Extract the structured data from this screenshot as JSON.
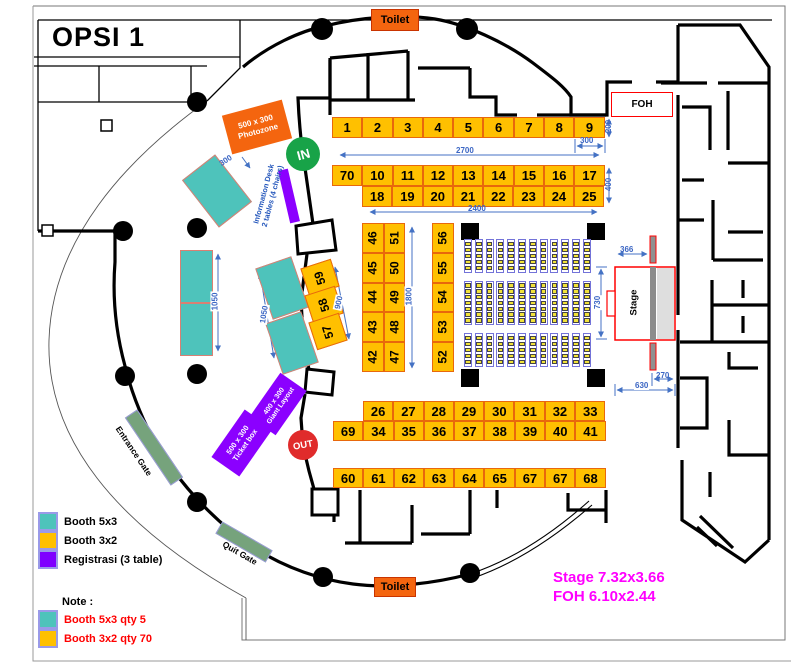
{
  "title": "OPSI 1",
  "badges": {
    "toilet_top": "Toilet",
    "toilet_bottom": "Toilet",
    "foh": "FOH",
    "stage": "Stage",
    "in_label": "IN",
    "out_label": "OUT"
  },
  "gates": {
    "entrance": "Entrance Gate",
    "quit": "Quit Gate"
  },
  "areas": {
    "photozone_line1": "500 x 300",
    "photozone_line2": "Photozone",
    "info_desk_line1": "Information Desk",
    "info_desk_line2": "2 tables (4 chairs)",
    "giant_line1": "400 x 300",
    "giant_line2": "Giant Layout",
    "ticket_line1": "500 x 300",
    "ticket_line2": "Ticket box"
  },
  "booths": {
    "row_1_9": [
      "1",
      "2",
      "3",
      "4",
      "5",
      "6",
      "7",
      "8",
      "9"
    ],
    "row_70_17": [
      "70",
      "10",
      "11",
      "12",
      "13",
      "14",
      "15",
      "16",
      "17"
    ],
    "row_18_25": [
      "18",
      "19",
      "20",
      "21",
      "22",
      "23",
      "24",
      "25"
    ],
    "row_26_33": [
      "26",
      "27",
      "28",
      "29",
      "30",
      "31",
      "32",
      "33"
    ],
    "row_69_41": [
      "69",
      "34",
      "35",
      "36",
      "37",
      "38",
      "39",
      "40",
      "41"
    ],
    "row_60_68": [
      "60",
      "61",
      "62",
      "63",
      "64",
      "65",
      "67",
      "67",
      "68"
    ],
    "col_46_42": [
      "46",
      "45",
      "44",
      "43",
      "42"
    ],
    "col_51_47": [
      "51",
      "50",
      "49",
      "48",
      "47"
    ],
    "col_56_52": [
      "56",
      "55",
      "54",
      "53",
      "52"
    ],
    "diag_59_57": [
      "59",
      "58",
      "57"
    ]
  },
  "dimensions": {
    "row_a_width": "2700",
    "booth9_width": "300",
    "row_a_depth": "200",
    "row_bc_width": "2400",
    "row_bc_depth": "400",
    "col_height": "1800",
    "diag_height": "900",
    "teal_left": "1050",
    "teal_mid": "1050",
    "teal_single": "300",
    "stage_wing": "366",
    "stage_height": "730",
    "stage_right": "270",
    "stage_width": "630"
  },
  "legend": {
    "items": [
      {
        "label": "Booth 5x3",
        "color": "#4EC3BB"
      },
      {
        "label": "Booth 3x2",
        "color": "#FFC000"
      },
      {
        "label": "Registrasi (3 table)",
        "color": "#7F00FF"
      }
    ],
    "note_title": "Note :",
    "notes": [
      {
        "label": "Booth 5x3 qty 5",
        "color": "#4EC3BB"
      },
      {
        "label": "Booth 3x2 qty 70",
        "color": "#FFC000"
      }
    ]
  },
  "footnote": {
    "stage": "Stage 7.32x3.66",
    "foh": "FOH 6.10x2.44"
  }
}
